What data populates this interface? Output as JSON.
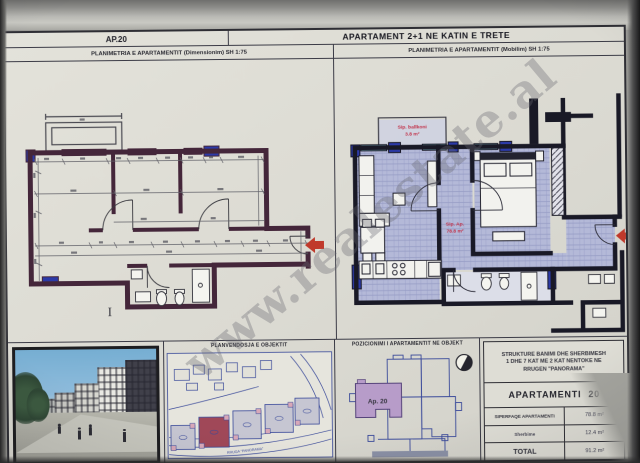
{
  "header": {
    "ap_code": "AP.20",
    "title": "APARTAMENT 2+1 NE KATIN E TRETE"
  },
  "plans": {
    "dimension": {
      "title": "PLANIMETRIA E APARTAMENTIT (Dimensionim) SH 1:75"
    },
    "furnished": {
      "title": "PLANIMETRIA E APARTAMENTIT (Mobilim) SH 1:75",
      "balcony_label": "Sip. ballkoni",
      "balcony_area": "3.8 m²",
      "apartment_label": "Sip. Ap.",
      "apartment_area": "78.8 m²"
    }
  },
  "site": {
    "title": "PLANVENDOSJA E OBJEKTIT",
    "street_label": "RRUGA \"PANORAMA\""
  },
  "position": {
    "title": "POZICIONIMI I APARTAMENTIT NE OBJEKT",
    "apartment_label": "Ap. 20"
  },
  "info_table": {
    "header_line1": "STRUKTURE BANIMI DHE SHERBIMESH",
    "header_line2": "1 DHE 7 KAT ME 2 KAT NENTOKE NE",
    "header_line3": "RRUGEN \"PANORAMA\"",
    "apartment_label": "APARTAMENTI",
    "apartment_number": "20",
    "rows": [
      {
        "label": "SIPERFAQE APARTAMENTI",
        "value": "78.8 m²"
      },
      {
        "label": "Sherbime",
        "value": "12.4 m²"
      },
      {
        "label": "TOTAL",
        "value": "91.2 m²"
      }
    ]
  },
  "watermark": {
    "text": "www.realestate.al"
  },
  "marks": {
    "stray": "I"
  },
  "colors": {
    "accent_red": "#c0392b",
    "wall_dark_left": "#44263a",
    "wall_dark_right": "#191926",
    "ink_blue": "#3a4a9a",
    "floor_lavender": "#b4b9d8",
    "window_cyan": "#8fd6de",
    "window_blue": "#2c3aa8",
    "highlight_building_red": "#a04858",
    "highlight_apartment_purple": "#b79cc9"
  }
}
